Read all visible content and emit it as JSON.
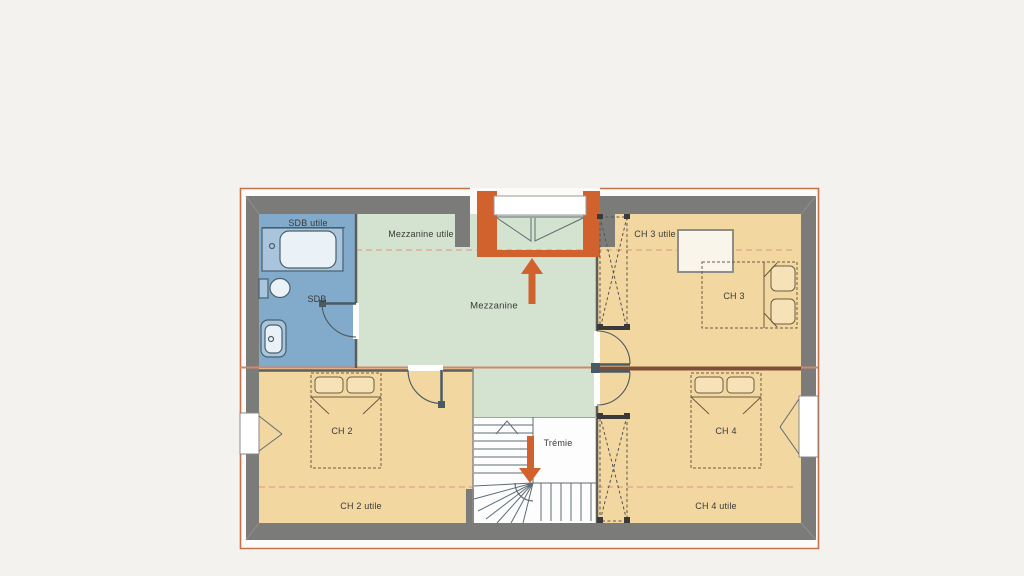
{
  "plan": {
    "type": "house-floor-plan-upper-storey",
    "rooms": [
      {
        "id": "sdb",
        "label": "SDB",
        "area_label": "SDB utile",
        "fixtures": [
          "bathtub",
          "toilet",
          "washbasin",
          "door"
        ]
      },
      {
        "id": "mezzanine",
        "label": "Mezzanine",
        "area_label": "Mezzanine utile",
        "fixtures": [
          "window-bay",
          "stair-up-arrow"
        ]
      },
      {
        "id": "ch2",
        "label": "CH 2",
        "area_label": "CH 2 utile",
        "fixtures": [
          "double-bed",
          "window",
          "door"
        ]
      },
      {
        "id": "ch3",
        "label": "CH 3",
        "area_label": "CH 3 utile",
        "fixtures": [
          "double-bed",
          "roof-window",
          "wardrobe",
          "door"
        ]
      },
      {
        "id": "ch4",
        "label": "CH 4",
        "area_label": "CH 4 utile",
        "fixtures": [
          "double-bed",
          "window",
          "wardrobe",
          "door"
        ]
      }
    ],
    "stairwell": {
      "label": "Trémie",
      "fixtures": [
        "winder-staircase",
        "stair-down-arrow"
      ]
    },
    "colors": {
      "wall_gray": "#7b7b79",
      "bathroom_blue": "#82aaca",
      "mezzanine_green": "#d4e3cf",
      "bedroom_tan": "#f3d7a0",
      "accent_orange": "#d2622d",
      "thin_border_orange": "#c4714c",
      "section_line_salmon": "#cf8a6d",
      "usable_area_dashed": "#e0a28e",
      "outline_dark": "#4a5a62",
      "fixture_blue": "#a9c5dd",
      "fixture_light": "#eaf2f8",
      "stairs_white": "#fdfdfd"
    }
  }
}
